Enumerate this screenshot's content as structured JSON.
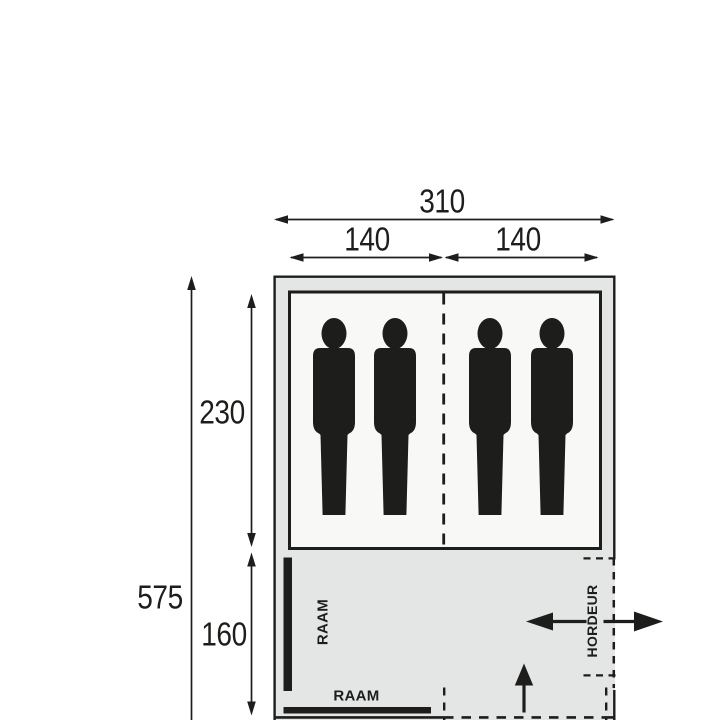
{
  "title": "tent-floorplan",
  "colors": {
    "background": "#ffffff",
    "line": "#1d1d1b",
    "tent_fill": "#e4e6e5",
    "cabin_fill": "#f8f8f6"
  },
  "dimensions": {
    "total_width": "310",
    "cabin_left_width": "140",
    "cabin_right_width": "140",
    "total_length": "575",
    "cabin_length": "230",
    "living_length": "160"
  },
  "labels": {
    "window_left": "RAAM",
    "window_bottom": "RAAM",
    "screen_door": "HORDEUR"
  },
  "figures": {
    "person_count": 4
  }
}
